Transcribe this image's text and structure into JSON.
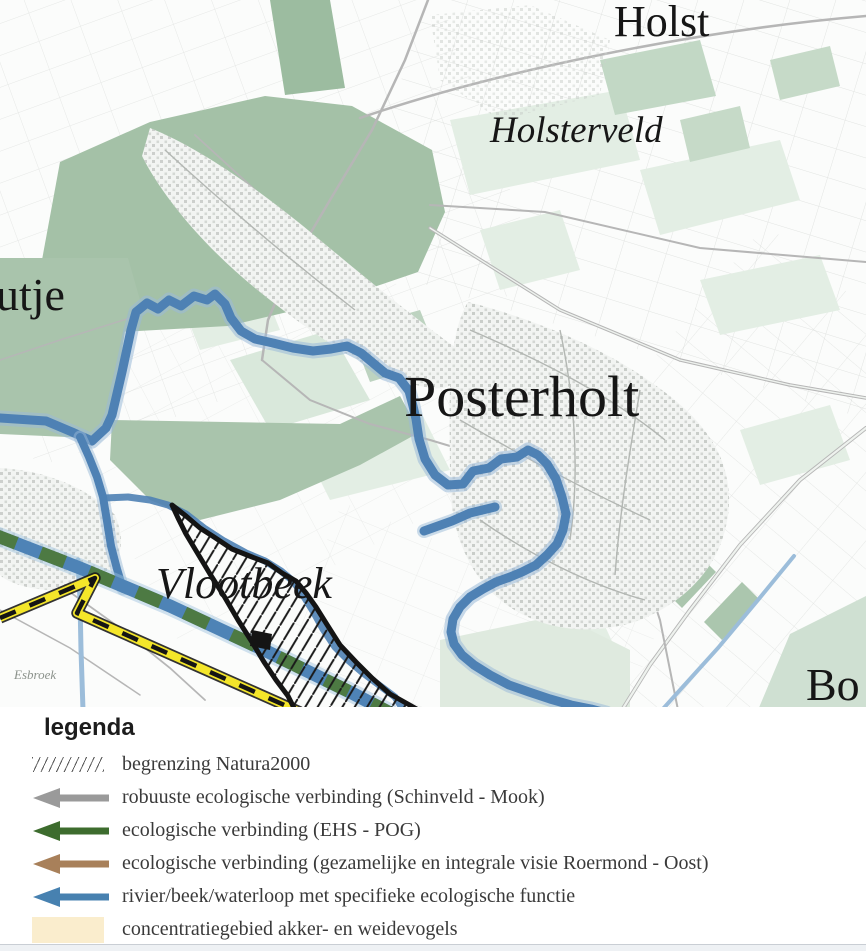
{
  "map": {
    "labels": {
      "holst": "Holst",
      "holsterveld": "Holsterveld",
      "utje_partial": "utje",
      "posterholt": "Posterholt",
      "vlootbeek": "Vlootbeek",
      "esbroek": "Esbroek",
      "bo_partial": "Bo"
    },
    "colors": {
      "river_blue": "#4e81b4",
      "river_halo": "#9ab9d8",
      "band_green": "#4d7a43",
      "band_blue": "#4e83b6",
      "route_yellow": "#f4e62a",
      "natura_outline": "#141414",
      "forest_green": "#a4c1a7",
      "field_green": "#e3eee4"
    }
  },
  "legend": {
    "title": "legenda",
    "items": [
      {
        "label": "begrenzing Natura2000",
        "swatch": "hatch",
        "color": "#5a5a5a"
      },
      {
        "label": "robuuste ecologische verbinding (Schinveld - Mook)",
        "swatch": "arrow",
        "color": "#9a9a9a"
      },
      {
        "label": "ecologische verbinding (EHS - POG)",
        "swatch": "arrow",
        "color": "#3d6c2e"
      },
      {
        "label": "ecologische verbinding (gezamelijke en integrale visie Roermond - Oost)",
        "swatch": "arrow",
        "color": "#a8805a"
      },
      {
        "label": "rivier/beek/waterloop met specifieke ecologische functie",
        "swatch": "arrow",
        "color": "#4781b0"
      },
      {
        "label": "concentratiegebied akker- en weidevogels",
        "swatch": "fill",
        "color": "#faedcd"
      }
    ]
  }
}
